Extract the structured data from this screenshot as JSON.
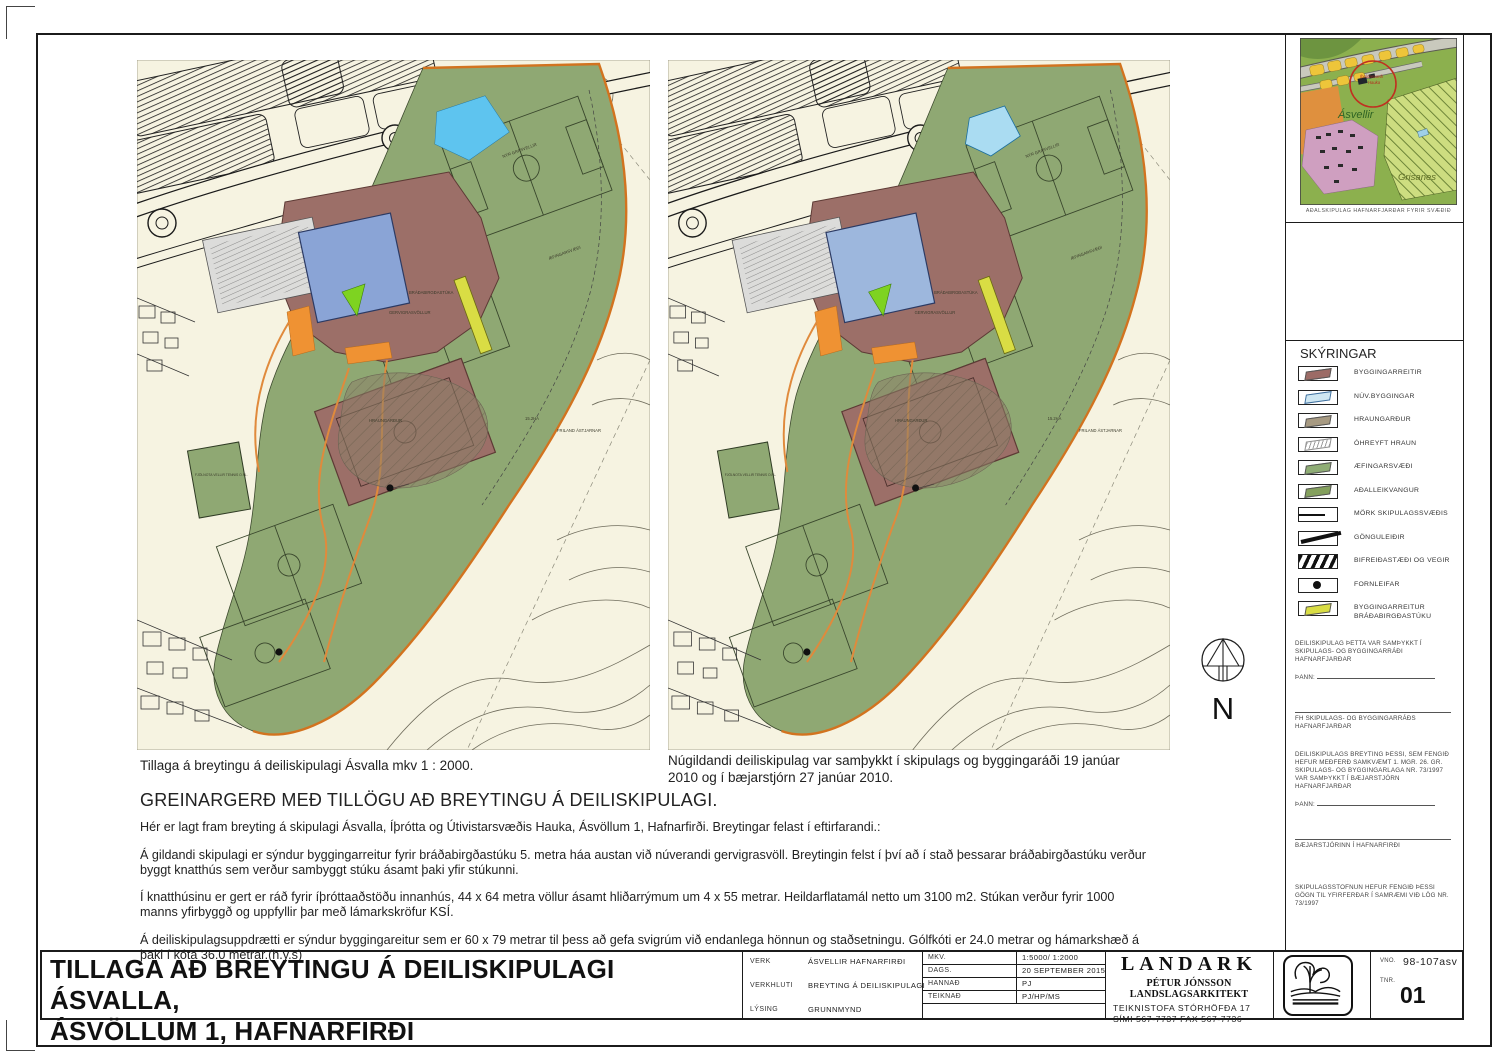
{
  "captions": {
    "left_map": "Tillaga á breytingu á deiliskipulagi Ásvalla mkv 1 : 2000.",
    "right_map": "Núgildandi deiliskipulag var samþykkt í skipulags og byggingaráði 19 janúar 2010 og í bæjarstjórn 27 janúar 2010."
  },
  "report": {
    "heading": "GREINARGERÐ MEÐ TILLÖGU AÐ BREYTINGU Á DEILISKIPULAGI.",
    "paragraphs": [
      "Hér er lagt fram breyting á skipulagi  Ásvalla, Íþrótta og Útivistarsvæðis Hauka, Ásvöllum 1, Hafnarfirði.   Breytingar felast í eftirfarandi.:",
      "Á gildandi skipulagi er sýndur byggingarreitur fyrir bráðabirgðastúku 5. metra háa austan við núverandi gervigrasvöll.  Breytingin felst í því að í stað þessarar bráðabirgðastúku verður byggt knatthús sem verður sambyggt stúku ásamt þaki yfir stúkunni.",
      "Í knatthúsinu er gert er ráð fyrir íþróttaaðstöðu innanhús,  44 x 64 metra völlur ásamt hliðarrýmum um 4 x 55 metrar.  Heildarflatamál netto um 3100 m2.  Stúkan verður fyrir 1000 manns yfirbyggð og uppfyllir þar með lámarkskröfur KSÍ.",
      "Á deiliskipulagsuppdrætti er sýndur byggingareitur sem er 60 x 79  metrar til þess að gefa svigrúm við endanlega hönnun og staðsetningu. Gólfkóti er  24.0 metrar og hámarkshæð á þaki í kóta 36.0 metrar.(h.y.s)"
    ]
  },
  "maps": {
    "shared_labels": {
      "grasvellir": "NÝR GRASVELLIR",
      "aefingasvaedi": "ÆFINGARSVÆÐI",
      "gervigras": "GERVIGRASVÖLLUR",
      "bradabirgdastuka": "BRÁÐABIRGÐASTÚKA",
      "hraungardur": "HRAUNGARÐUR",
      "fjolnota": "FJÖLNOTA VELLIR TENNIS O.FL.",
      "ha": "15.2HA",
      "friland": "FRILAND ÁSTJARNAR"
    }
  },
  "inset_map": {
    "caption": "AÐALSKIPULAG HAFNARFJARÐAR FYRIR SVÆÐIÐ",
    "labels": {
      "asvellir": "Ásvellir",
      "grisanes": "Grisanes",
      "marker_line1": "Íþróttasvæði",
      "marker_line2": "Hauka"
    }
  },
  "legend": {
    "title": "SKÝRINGAR",
    "items": [
      {
        "label": "BYGGINGARREITIR",
        "color": "#9c6b66"
      },
      {
        "label": "NÚV.BYGGINGAR",
        "color": "#cfe7f2"
      },
      {
        "label": "HRAUNGARÐUR",
        "color": "#a79a82"
      },
      {
        "label": "ÓHREYFT HRAUN",
        "color": "#ffffff"
      },
      {
        "label": "ÆFINGARSVÆÐI",
        "color": "#8fad75"
      },
      {
        "label": "AÐALLEIKVANGUR",
        "color": "#84a05d"
      },
      {
        "label": "MÖRK SKIPULAGSSVÆÐIS",
        "color": "#111111"
      },
      {
        "label": "GÖNGULEIÐIR",
        "color": "#111111"
      },
      {
        "label": "BIFREIÐASTÆÐI OG VEGIR",
        "color": "#111111"
      },
      {
        "label": "FORNLEIFAR",
        "color": "#111111"
      },
      {
        "label": "BYGGINGARREITUR\nBRÁÐABIRGÐASTÚKU",
        "color": "#d9dd44"
      }
    ]
  },
  "approval": {
    "p1": "DEILISKIPULAG ÞETTA VAR SAMÞYKKT Í SKIPULAGS- OG BYGGINGARRÁÐI HAFNARFJARÐAR",
    "dated_label": "ÞANN:",
    "sig1": "FH SKIPULAGS- OG BYGGINGARRÁÐS HAFNARFJARÐAR",
    "p2": "DEILISKIPULAGS BREYTING ÞESSI, SEM FENGIÐ HEFUR MEÐFERÐ SAMKVÆMT 1. MGR. 26. GR. SKIPULAGS- OG BYGGINGARLAGA NR. 73/1997 VAR SAMÞYKKT Í BÆJARSTJÓRN HAFNARFJARÐAR",
    "dated_label2": "ÞANN:",
    "sig2": "BÆJARSTJÓRINN Í HAFNARFIRÐI",
    "p3": "SKIPULAGSSTOFNUN HEFUR FENGIÐ ÞESSI GÖGN TIL YFIRFERÐAR Í SAMRÆMI VIÐ LÖG NR. 73/1997"
  },
  "north_label": "N",
  "titleblock": {
    "title_line1": "TILLAGA AÐ BREYTINGU Á  DEILISKIPULAGI ÁSVALLA,",
    "title_line2": "ÁSVÖLLUM 1, HAFNARFIRÐI",
    "fields": {
      "verk_label": "VERK",
      "verk": "ÁSVELLIR HAFNARFIRÐI",
      "verkhluti_label": "VERKHLUTI",
      "verkhluti": "BREYTING Á DEILISKIPULAGI",
      "lysing_label": "LÝSING",
      "lysing": "GRUNNMYND",
      "mkv_label": "MKV.",
      "mkv": "1:5000/ 1:2000",
      "dags_label": "DAGS.",
      "dags": "20 SEPTEMBER 2015",
      "hannad_label": "HANNAÐ",
      "hannad": "PJ",
      "teiknad_label": "TEIKNAÐ",
      "teiknad": "PJ/HP/MS"
    },
    "company": {
      "name": "LANDARK",
      "subtitle": "PÉTUR JÓNSSON LANDSLAGSARKITEKT",
      "address": "TEIKNISTOFA STÓRHÖFÐA 17",
      "phone": "SÍMI 567-7737    FAX 567-7736"
    },
    "vno_label": "VNO.",
    "vno": "98-107asv",
    "tnr_label": "TNR.",
    "tnr": "01"
  },
  "colors": {
    "boundary_orange": "#d2731f",
    "green_area": "#8fa873",
    "building_red": "#9c6f68",
    "building_blue": "#8aa4d6",
    "temp_stand_yellow": "#d9dd44",
    "existing_blue": "#cfe7f2"
  }
}
